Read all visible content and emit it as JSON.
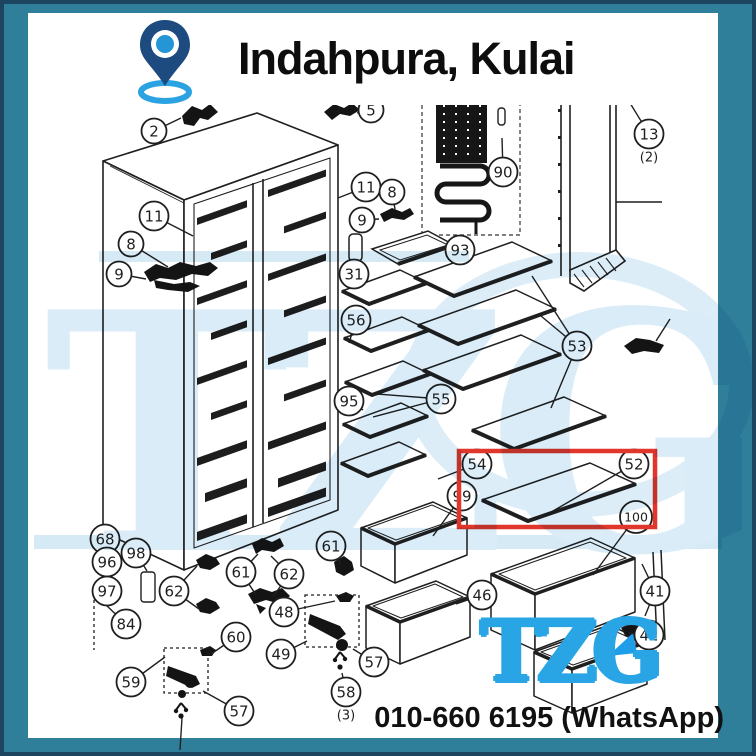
{
  "frame": {
    "border_color": "#1d4560",
    "background_color": "#2f7e9a",
    "panel_color": "#ffffff"
  },
  "header": {
    "title": "Indahpura, Kulai",
    "pin": {
      "body_color": "#1d4b80",
      "dot_color": "#2496d8",
      "ring_color": "#2ba3e2"
    }
  },
  "watermark": {
    "text": "TZG",
    "color": "#d9ecf8"
  },
  "brand": {
    "logo_text": "TZG",
    "logo_color": "#29a5e5"
  },
  "contact": {
    "phone": "010-660 6195 (WhatsApp)"
  },
  "highlight": {
    "color": "#e0362b"
  },
  "callouts": [
    {
      "label": "2",
      "x": 150,
      "y": 127,
      "leaders": [
        [
          177,
          114
        ]
      ]
    },
    {
      "label": "5",
      "x": 367,
      "y": 106,
      "leaders": [
        [
          353,
          109
        ]
      ]
    },
    {
      "label": "11",
      "x": 150,
      "y": 212,
      "leaders": [
        [
          189,
          232
        ]
      ]
    },
    {
      "label": "8",
      "x": 127,
      "y": 240,
      "leaders": [
        [
          164,
          263
        ]
      ]
    },
    {
      "label": "9",
      "x": 115,
      "y": 270,
      "leaders": [
        [
          142,
          275
        ]
      ]
    },
    {
      "label": "11",
      "x": 362,
      "y": 183,
      "leaders": [
        [
          334,
          194
        ]
      ]
    },
    {
      "label": "8",
      "x": 388,
      "y": 188,
      "leaders": [
        [
          391,
          205
        ]
      ]
    },
    {
      "label": "9",
      "x": 358,
      "y": 216,
      "leaders": [
        [
          375,
          215
        ]
      ]
    },
    {
      "label": "90",
      "x": 499,
      "y": 168,
      "leaders": [
        [
          498,
          134
        ]
      ]
    },
    {
      "label": "13",
      "x": 645,
      "y": 130,
      "sub": "(2)",
      "leaders": [
        [
          626,
          99
        ]
      ]
    },
    {
      "label": "93",
      "x": 456,
      "y": 246,
      "leaders": [
        [
          442,
          249
        ]
      ]
    },
    {
      "label": "31",
      "x": 350,
      "y": 270,
      "leaders": [
        [
          351,
          258
        ]
      ]
    },
    {
      "label": "56",
      "x": 352,
      "y": 316,
      "leaders": [
        [
          345,
          339
        ]
      ]
    },
    {
      "label": "53",
      "x": 573,
      "y": 342,
      "leaders": [
        [
          528,
          272
        ],
        [
          537,
          312
        ],
        [
          547,
          404
        ]
      ]
    },
    {
      "label": "95",
      "x": 345,
      "y": 397,
      "leaders": [
        [
          359,
          406
        ]
      ]
    },
    {
      "label": "55",
      "x": 437,
      "y": 395,
      "leaders": [
        [
          373,
          390
        ],
        [
          369,
          413
        ]
      ]
    },
    {
      "label": "54",
      "x": 473,
      "y": 460,
      "leaders": [
        [
          434,
          475
        ]
      ]
    },
    {
      "label": "52",
      "x": 630,
      "y": 460,
      "leaders": [
        [
          549,
          507
        ]
      ]
    },
    {
      "label": "99",
      "x": 458,
      "y": 492,
      "leaders": [
        [
          470,
          484
        ],
        [
          429,
          532
        ]
      ]
    },
    {
      "label": "100",
      "x": 632,
      "y": 513,
      "leaders": [
        [
          589,
          571
        ]
      ]
    },
    {
      "label": "46",
      "x": 478,
      "y": 591,
      "leaders": [
        [
          452,
          600
        ]
      ]
    },
    {
      "label": "41",
      "x": 651,
      "y": 587,
      "leaders": [
        [
          638,
          560
        ],
        [
          641,
          612
        ]
      ]
    },
    {
      "label": "42",
      "x": 645,
      "y": 631,
      "leaders": [
        [
          624,
          629
        ]
      ]
    },
    {
      "label": "68",
      "x": 101,
      "y": 535,
      "leaders": []
    },
    {
      "label": "96",
      "x": 103,
      "y": 558,
      "leaders": []
    },
    {
      "label": "98",
      "x": 132,
      "y": 549,
      "leaders": [
        [
          143,
          567
        ]
      ]
    },
    {
      "label": "97",
      "x": 103,
      "y": 587,
      "leaders": []
    },
    {
      "label": "84",
      "x": 122,
      "y": 620,
      "leaders": [
        [
          102,
          601
        ]
      ]
    },
    {
      "label": "62",
      "x": 170,
      "y": 587,
      "leaders": [
        [
          193,
          562
        ],
        [
          195,
          605
        ]
      ]
    },
    {
      "label": "61",
      "x": 237,
      "y": 568,
      "leaders": [
        [
          254,
          550
        ],
        [
          252,
          591
        ]
      ]
    },
    {
      "label": "62",
      "x": 285,
      "y": 570,
      "leaders": [
        [
          267,
          552
        ],
        [
          269,
          593
        ]
      ]
    },
    {
      "label": "61",
      "x": 327,
      "y": 542,
      "leaders": [
        [
          337,
          560
        ]
      ]
    },
    {
      "label": "48",
      "x": 280,
      "y": 608,
      "leaders": [
        [
          331,
          597
        ]
      ]
    },
    {
      "label": "49",
      "x": 277,
      "y": 650,
      "leaders": [
        [
          303,
          637
        ]
      ]
    },
    {
      "label": "57",
      "x": 370,
      "y": 658,
      "leaders": [
        [
          349,
          645
        ]
      ]
    },
    {
      "label": "58",
      "x": 342,
      "y": 688,
      "sub": "(3)",
      "leaders": [
        [
          338,
          669
        ]
      ]
    },
    {
      "label": "60",
      "x": 232,
      "y": 633,
      "leaders": [
        [
          207,
          650
        ]
      ]
    },
    {
      "label": "59",
      "x": 127,
      "y": 678,
      "leaders": [
        [
          161,
          653
        ]
      ]
    },
    {
      "label": "57",
      "x": 235,
      "y": 707,
      "leaders": [
        [
          199,
          687
        ]
      ]
    }
  ]
}
